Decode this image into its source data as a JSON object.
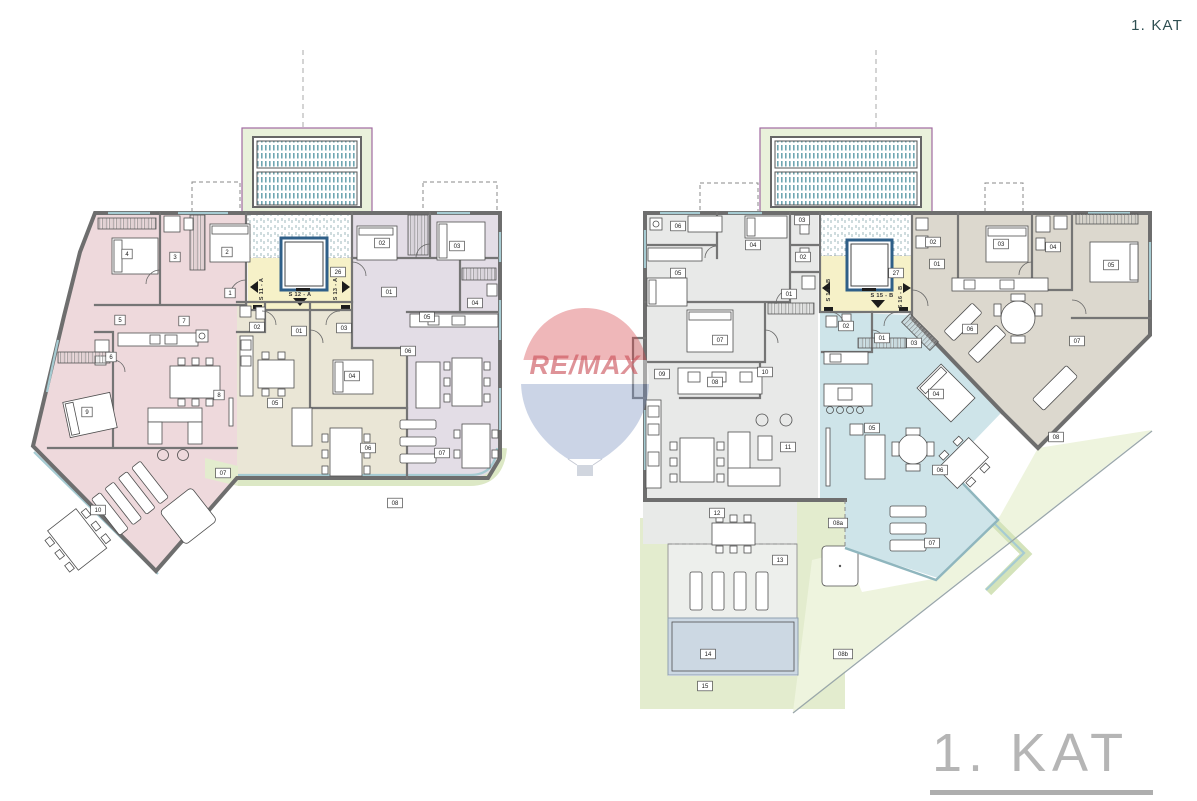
{
  "header": {
    "floor_label": "1. KAT"
  },
  "footer": {
    "floor_label": "1. KAT"
  },
  "watermark": {
    "brand": "RE/MAX"
  },
  "palette": {
    "wall": "#6e6e6e",
    "unit_pink": "#eed9dc",
    "unit_lavender": "#e3dde6",
    "unit_beige": "#eae6d6",
    "unit_gray": "#e8e9e8",
    "unit_blue": "#cee4e9",
    "unit_tan": "#dcd8ce",
    "stair_yellow": "#f6f1c8",
    "garden_green": "#e3ecce",
    "pool_blue": "#ccd8e3",
    "ramp_green": "#e9f1db",
    "title_gray": "#b5b5b5",
    "title_teal": "#2f4f52",
    "remax_red": "#d84b52",
    "remax_blue": "#7e93c0"
  },
  "plans": [
    {
      "id": "plan-a",
      "name": "A",
      "stair": {
        "core": {
          "t": "26",
          "x": 338,
          "y": 272
        },
        "texts": [
          {
            "t": "S 11 - A",
            "x": 263,
            "y": 289,
            "rot": -90
          },
          {
            "t": "S 12 - A",
            "x": 300,
            "y": 296,
            "rot": 0
          },
          {
            "t": "S 13 - A",
            "x": 337,
            "y": 289,
            "rot": -90
          }
        ]
      },
      "apartments": [
        {
          "key": "unit-pink",
          "labels": [
            {
              "t": "1",
              "x": 230,
              "y": 293
            },
            {
              "t": "2",
              "x": 227,
              "y": 252
            },
            {
              "t": "3",
              "x": 175,
              "y": 257
            },
            {
              "t": "4",
              "x": 127,
              "y": 254
            },
            {
              "t": "5",
              "x": 120,
              "y": 320
            },
            {
              "t": "6",
              "x": 111,
              "y": 357
            },
            {
              "t": "7",
              "x": 184,
              "y": 321
            },
            {
              "t": "8",
              "x": 219,
              "y": 395
            },
            {
              "t": "9",
              "x": 87,
              "y": 412
            },
            {
              "t": "10",
              "x": 98,
              "y": 510
            }
          ]
        },
        {
          "key": "unit-beige",
          "labels": [
            {
              "t": "01",
              "x": 299,
              "y": 331
            },
            {
              "t": "02",
              "x": 257,
              "y": 327
            },
            {
              "t": "03",
              "x": 344,
              "y": 328
            },
            {
              "t": "04",
              "x": 352,
              "y": 376
            },
            {
              "t": "05",
              "x": 275,
              "y": 403
            },
            {
              "t": "06",
              "x": 368,
              "y": 448
            }
          ]
        },
        {
          "key": "unit-lavender",
          "labels": [
            {
              "t": "01",
              "x": 389,
              "y": 292
            },
            {
              "t": "02",
              "x": 382,
              "y": 243
            },
            {
              "t": "03",
              "x": 457,
              "y": 246
            },
            {
              "t": "04",
              "x": 475,
              "y": 303
            },
            {
              "t": "05",
              "x": 427,
              "y": 317
            },
            {
              "t": "06",
              "x": 408,
              "y": 351
            },
            {
              "t": "07",
              "x": 442,
              "y": 453
            }
          ]
        }
      ],
      "outdoor_labels": [
        {
          "t": "07",
          "x": 223,
          "y": 473
        },
        {
          "t": "08",
          "x": 395,
          "y": 503
        }
      ]
    },
    {
      "id": "plan-b",
      "name": "B",
      "stair": {
        "core": {
          "t": "27",
          "x": 896,
          "y": 273
        },
        "texts": [
          {
            "t": "S 14 - B",
            "x": 830,
            "y": 290,
            "rot": -90
          },
          {
            "t": "S 15 - B",
            "x": 882,
            "y": 297,
            "rot": 0
          },
          {
            "t": "S 16 - B",
            "x": 902,
            "y": 297,
            "rot": -90
          }
        ]
      },
      "apartments": [
        {
          "key": "unit-gray",
          "labels": [
            {
              "t": "01",
              "x": 789,
              "y": 294
            },
            {
              "t": "02",
              "x": 803,
              "y": 257
            },
            {
              "t": "03",
              "x": 802,
              "y": 220
            },
            {
              "t": "04",
              "x": 753,
              "y": 245
            },
            {
              "t": "05",
              "x": 678,
              "y": 273
            },
            {
              "t": "06",
              "x": 678,
              "y": 226
            },
            {
              "t": "07",
              "x": 720,
              "y": 340
            },
            {
              "t": "08",
              "x": 715,
              "y": 382
            },
            {
              "t": "09",
              "x": 662,
              "y": 374
            },
            {
              "t": "10",
              "x": 765,
              "y": 372
            },
            {
              "t": "11",
              "x": 788,
              "y": 447
            },
            {
              "t": "12",
              "x": 717,
              "y": 513
            },
            {
              "t": "13",
              "x": 780,
              "y": 560
            },
            {
              "t": "14",
              "x": 708,
              "y": 654
            },
            {
              "t": "15",
              "x": 705,
              "y": 686
            }
          ]
        },
        {
          "key": "unit-blue",
          "labels": [
            {
              "t": "01",
              "x": 882,
              "y": 338
            },
            {
              "t": "02",
              "x": 846,
              "y": 326
            },
            {
              "t": "03",
              "x": 914,
              "y": 343
            },
            {
              "t": "04",
              "x": 936,
              "y": 394
            },
            {
              "t": "05",
              "x": 872,
              "y": 428
            },
            {
              "t": "06",
              "x": 940,
              "y": 470
            },
            {
              "t": "07",
              "x": 932,
              "y": 543
            }
          ]
        },
        {
          "key": "unit-tan",
          "labels": [
            {
              "t": "01",
              "x": 937,
              "y": 264
            },
            {
              "t": "02",
              "x": 933,
              "y": 242
            },
            {
              "t": "03",
              "x": 1001,
              "y": 244
            },
            {
              "t": "04",
              "x": 1053,
              "y": 247
            },
            {
              "t": "05",
              "x": 1111,
              "y": 265
            },
            {
              "t": "06",
              "x": 970,
              "y": 329
            },
            {
              "t": "07",
              "x": 1077,
              "y": 341
            },
            {
              "t": "08",
              "x": 1056,
              "y": 437
            }
          ]
        }
      ],
      "outdoor_labels": [
        {
          "t": "08a",
          "x": 838,
          "y": 523
        },
        {
          "t": "08b",
          "x": 843,
          "y": 654
        }
      ]
    }
  ]
}
